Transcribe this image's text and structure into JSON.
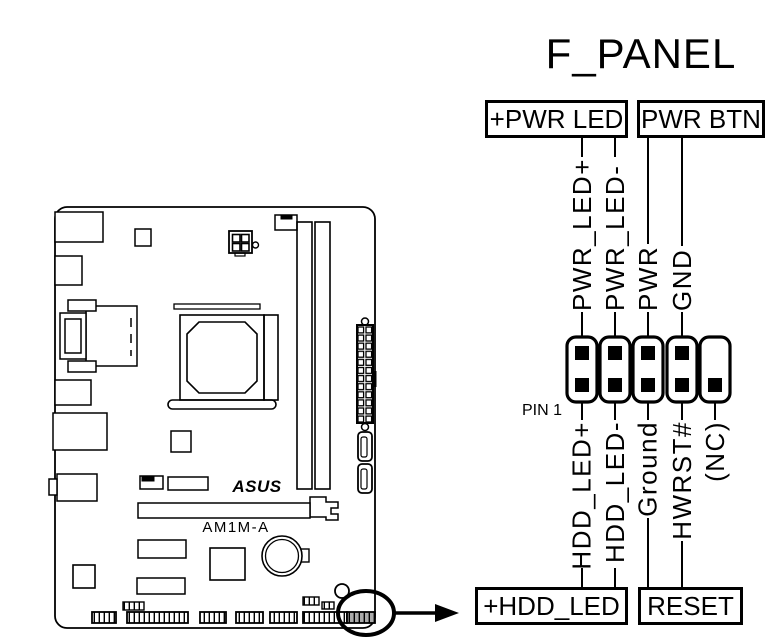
{
  "title": "F_PANEL",
  "boxes": {
    "pwr_led": "+PWR LED",
    "pwr_btn": "PWR BTN",
    "hdd_led": "+HDD_LED",
    "reset": "RESET"
  },
  "pin1_label": "PIN 1",
  "pins": {
    "top": [
      "PWR_LED+",
      "PWR_LED-",
      "PWR",
      "GND"
    ],
    "bottom": [
      "HDD_LED+",
      "HDD_LED-",
      "Ground",
      "HWRST#",
      "(NC)"
    ]
  },
  "header": {
    "columns": 5,
    "rows": 2,
    "missing_pin": "top row, column 5"
  },
  "motherboard": {
    "brand": "ASUS",
    "model": "AM1M-A"
  },
  "colors": {
    "ink": "#000000",
    "background": "#ffffff",
    "highlight": "#aaaaaa"
  }
}
